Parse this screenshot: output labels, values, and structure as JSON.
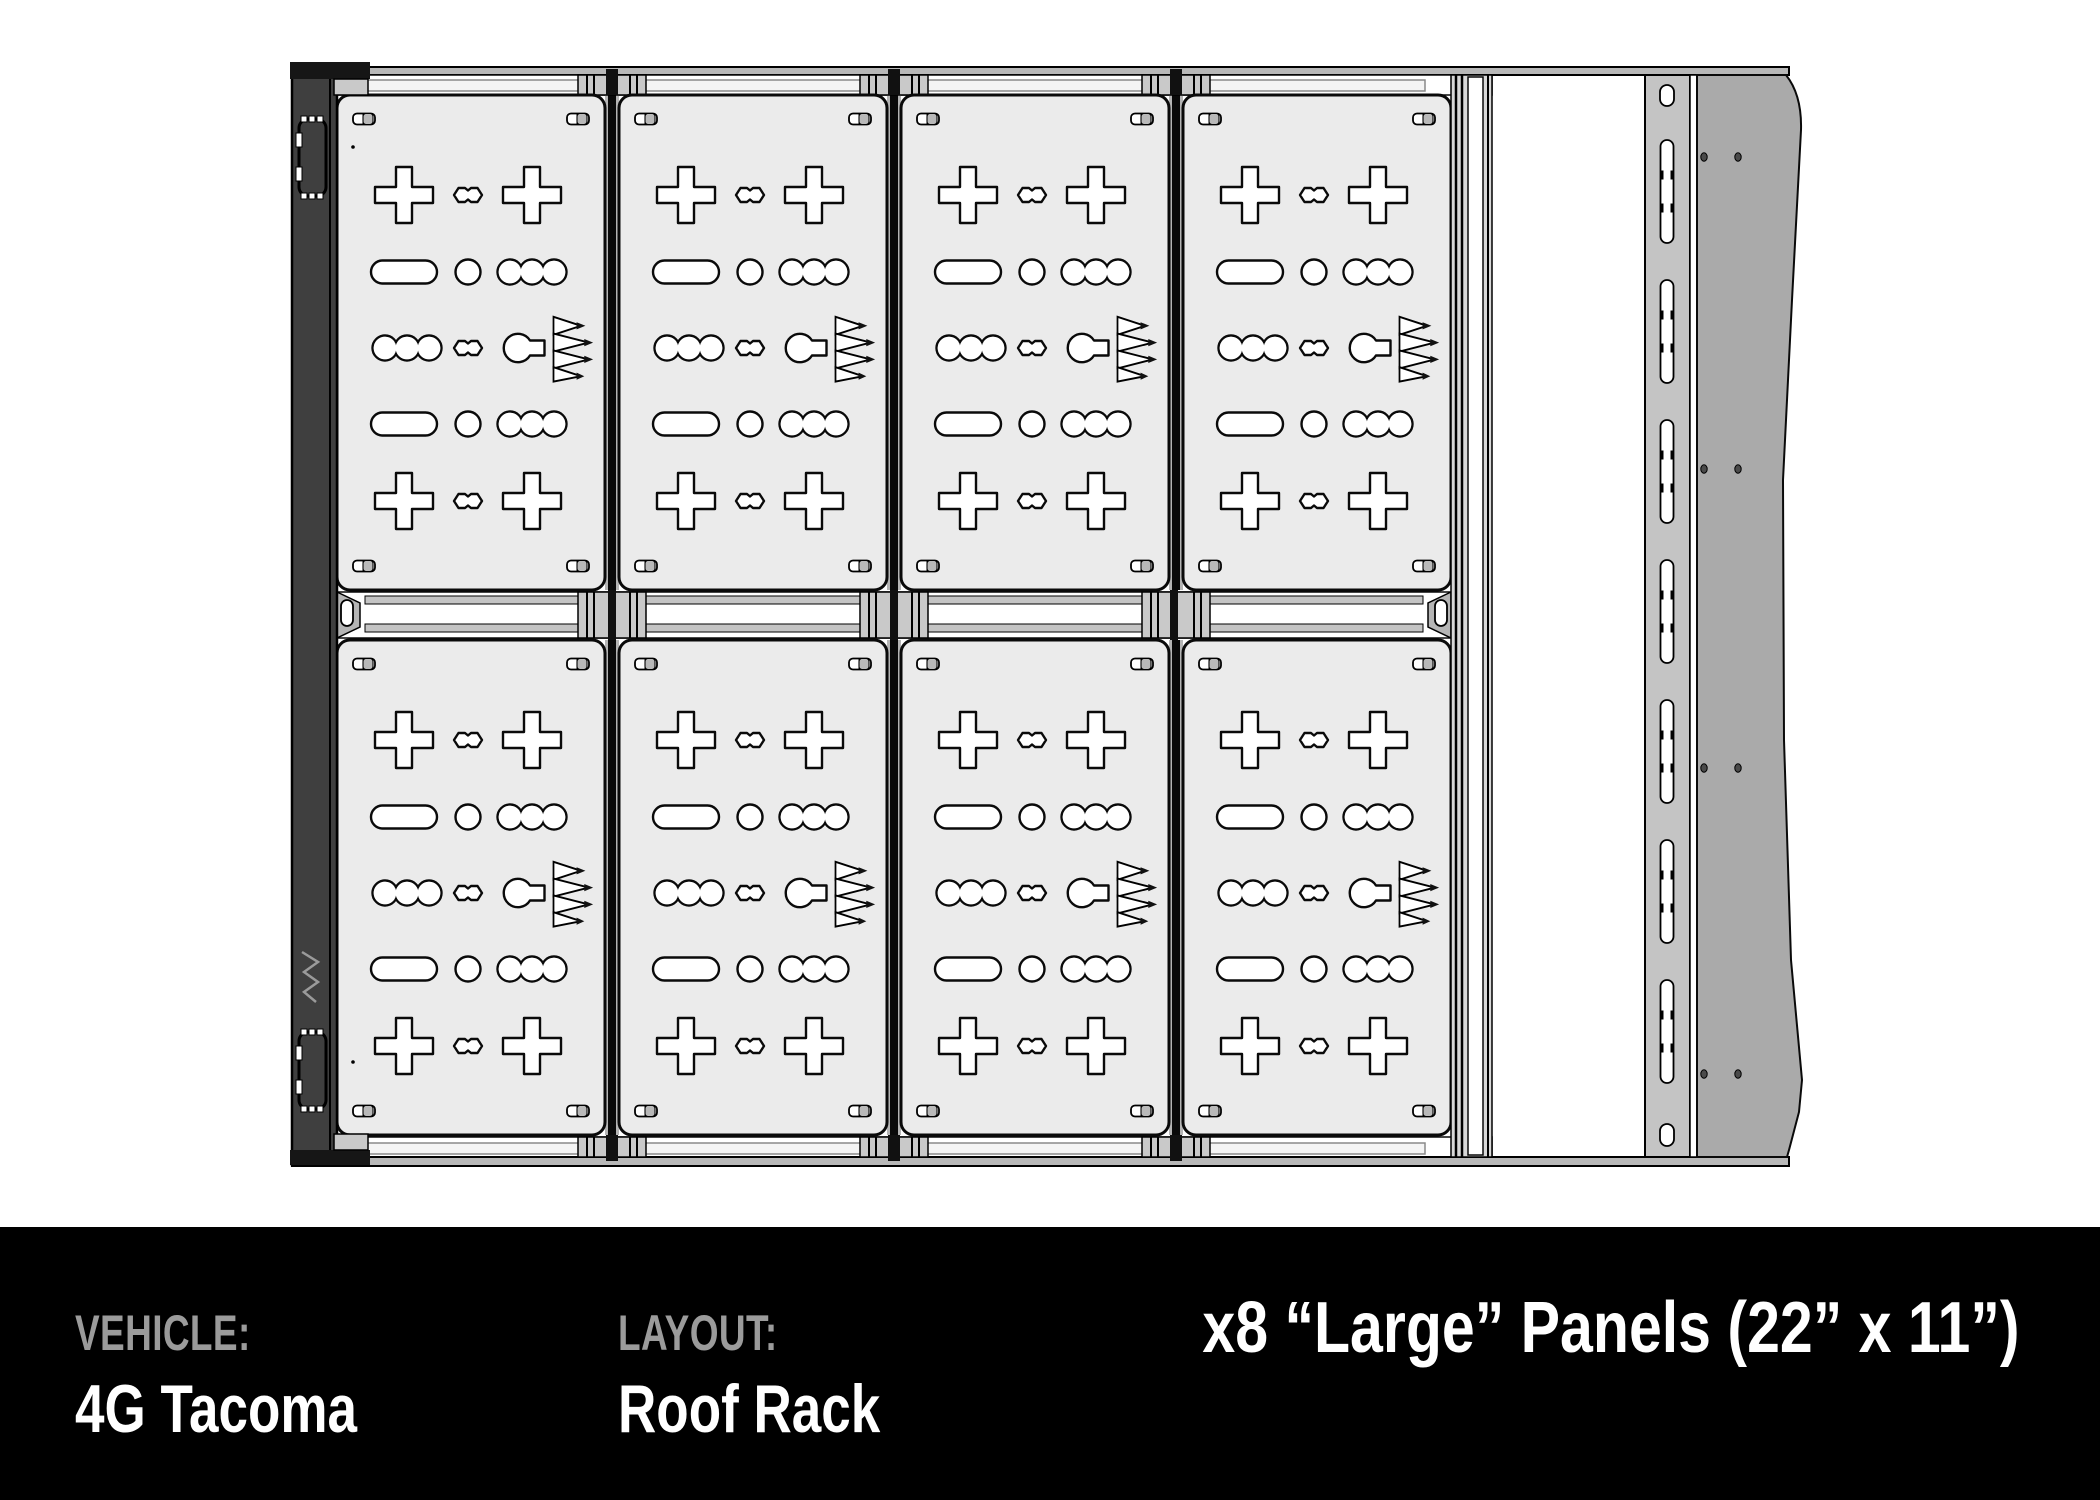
{
  "footer": {
    "fields": [
      {
        "label": "VEHICLE:",
        "value": "4G Tacoma"
      },
      {
        "label": "LAYOUT:",
        "value": "Roof Rack"
      }
    ],
    "summary": "x8 “Large” Panels (22” x 11”)"
  },
  "diagram": {
    "view": "Top-down CAD line drawing of a truck roof rack",
    "vehicle": "4G Tacoma",
    "layout": "Roof Rack",
    "panel_type": "Large",
    "panel_dimensions": "22” x 11”",
    "panel_count": 8,
    "grid": {
      "rows": 2,
      "columns": 4
    },
    "panel_cutouts_per_row": [
      "cross slot, bowtie slot, cross slot",
      "oblong slot, round hole, scalloped tri-slot",
      "scalloped tri-slot, bowtie slot, keyhole slot, mountain logo cutout",
      "oblong slot, round hole, scalloped tri-slot",
      "cross slot, bowtie slot, cross slot"
    ],
    "colors": {
      "panel_fill": "#ebebeb",
      "cutout_fill": "#ffffff",
      "outline": "#0a0a0a",
      "side_rail_fill": "#3f3f3f",
      "cross_rail_fill": "#c6c6c6",
      "accessory_channel_fill": "#c4c4c4",
      "fairing_fill": "#aaaaaa",
      "footer_background": "#000000",
      "footer_label_color": "#9b9b9b",
      "footer_value_color": "#ffffff"
    }
  }
}
